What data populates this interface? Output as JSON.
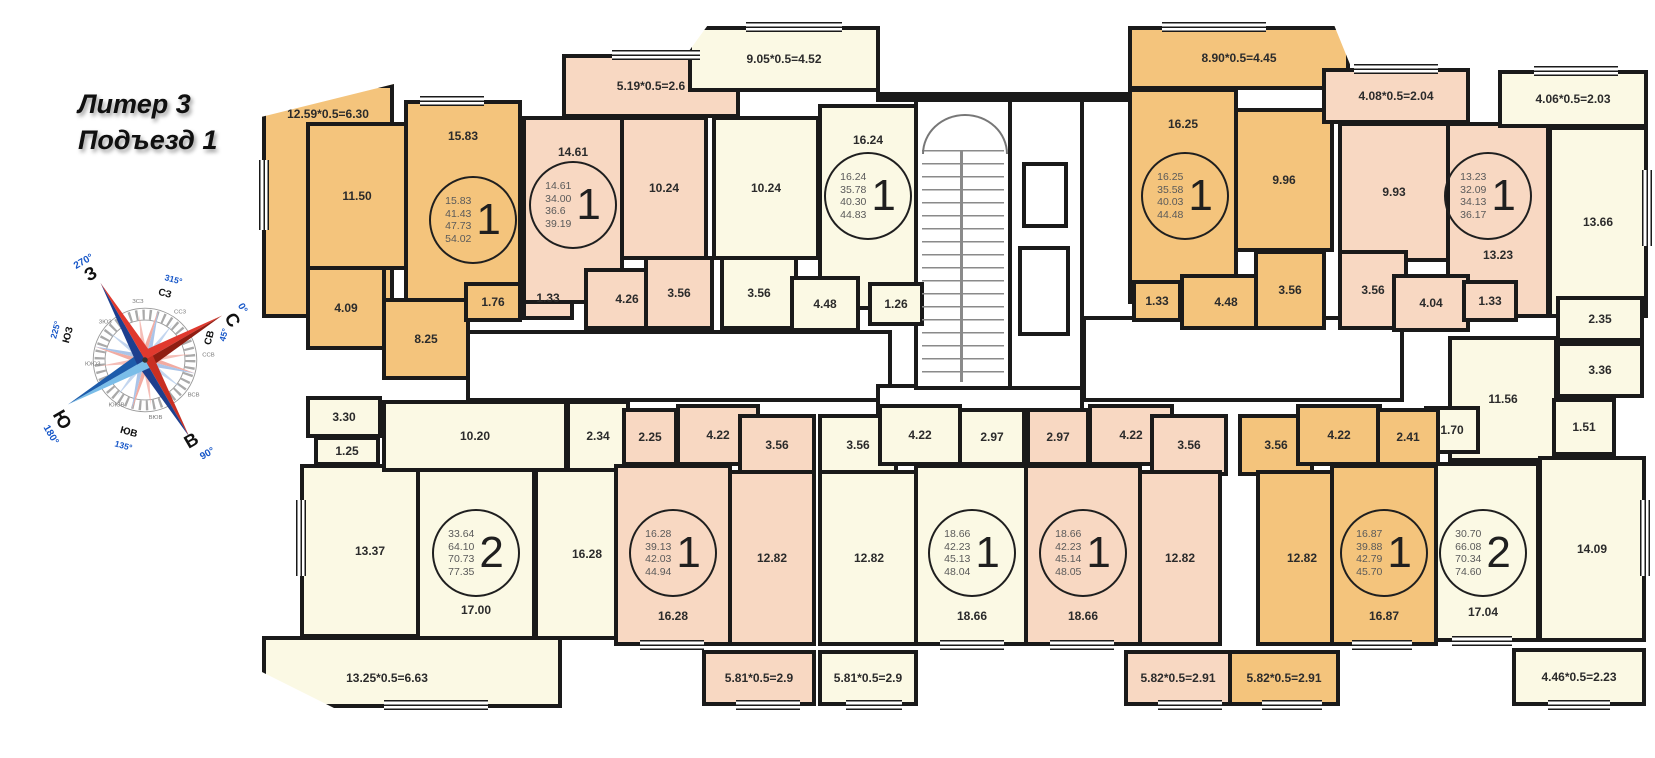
{
  "title": {
    "line1": "Литер 3",
    "line2": "Подъезд 1"
  },
  "compass": {
    "n": "С",
    "e": "В",
    "s": "Ю",
    "w": "З",
    "deg_n": "0°",
    "deg_e": "90°",
    "deg_s": "180°",
    "deg_w": "270°",
    "nw": "СЗ",
    "ne": "СВ",
    "se": "ЮВ",
    "sw": "ЮЗ",
    "deg_nw": "315°",
    "deg_ne": "45°",
    "deg_se": "135°",
    "deg_sw": "225°",
    "minor": [
      "ЗСЗ",
      "ССЗ",
      "ССВ",
      "ВСВ",
      "ВЮВ",
      "ЮЮВ",
      "ЮЮЗ",
      "ЗЮЗ"
    ]
  },
  "colors": {
    "orange": "#F4C47C",
    "pink": "#F8D8C2",
    "cream": "#FBF9E4",
    "wall": "#1a1a1a"
  },
  "rooms": [
    {
      "id": "apt1-balcony",
      "label": "12.59*0.5=6.30",
      "x": 262,
      "y": 84,
      "w": 132,
      "h": 234,
      "c": "o",
      "lp": "t",
      "clip": "polygon(0% 14%, 100% 0%, 100% 100%, 0% 100%)"
    },
    {
      "id": "apt1-kitchen",
      "label": "11.50",
      "x": 306,
      "y": 122,
      "w": 102,
      "h": 148,
      "c": "o",
      "lp": "c"
    },
    {
      "id": "apt1-room",
      "label": "15.83",
      "x": 404,
      "y": 100,
      "w": 118,
      "h": 202,
      "c": "o",
      "lp": "t"
    },
    {
      "id": "apt1-bath",
      "label": "4.09",
      "x": 306,
      "y": 266,
      "w": 80,
      "h": 84,
      "c": "o",
      "lp": "c"
    },
    {
      "id": "apt1-hall",
      "label": "8.25",
      "x": 382,
      "y": 298,
      "w": 88,
      "h": 82,
      "c": "o",
      "lp": "c"
    },
    {
      "id": "apt1-closet",
      "label": "1.76",
      "x": 464,
      "y": 282,
      "w": 58,
      "h": 40,
      "c": "o",
      "lp": "c"
    },
    {
      "id": "apt2-bath",
      "label": "3.30",
      "x": 306,
      "y": 396,
      "w": 76,
      "h": 42,
      "c": "c",
      "lp": "c"
    },
    {
      "id": "apt2-wc",
      "label": "1.25",
      "x": 314,
      "y": 436,
      "w": 66,
      "h": 30,
      "c": "c",
      "lp": "c"
    },
    {
      "id": "apt2-kitchen",
      "label": "13.37",
      "x": 300,
      "y": 464,
      "w": 140,
      "h": 174,
      "c": "c",
      "lp": "c"
    },
    {
      "id": "apt2-hall",
      "label": "10.20",
      "x": 382,
      "y": 400,
      "w": 186,
      "h": 72,
      "c": "c",
      "lp": "c"
    },
    {
      "id": "apt2-closet",
      "label": "2.34",
      "x": 566,
      "y": 400,
      "w": 64,
      "h": 72,
      "c": "c",
      "lp": "c"
    },
    {
      "id": "apt2-room1",
      "label": "17.00",
      "x": 416,
      "y": 468,
      "w": 120,
      "h": 172,
      "c": "c",
      "lp": "b"
    },
    {
      "id": "apt2-room2",
      "label": "16.28",
      "x": 534,
      "y": 468,
      "w": 106,
      "h": 172,
      "c": "c",
      "lp": "c"
    },
    {
      "id": "apt2-balcony",
      "label": "13.25*0.5=6.63",
      "x": 262,
      "y": 636,
      "w": 300,
      "h": 72,
      "c": "c",
      "lp": "c",
      "clip": "polygon(0% 0%, 100% 0%, 100% 100%, 24% 100%, 0% 50%)"
    },
    {
      "id": "apt3-closet",
      "label": "1.33",
      "x": 522,
      "y": 276,
      "w": 52,
      "h": 44,
      "c": "p",
      "lp": "c"
    },
    {
      "id": "apt3-room",
      "label": "14.61",
      "x": 522,
      "y": 116,
      "w": 102,
      "h": 188,
      "c": "p",
      "lp": "t"
    },
    {
      "id": "apt3-balcony",
      "label": "5.19*0.5=2.6",
      "x": 562,
      "y": 54,
      "w": 178,
      "h": 64,
      "c": "p",
      "lp": "c"
    },
    {
      "id": "apt3-kitchen",
      "label": "10.24",
      "x": 620,
      "y": 116,
      "w": 88,
      "h": 144,
      "c": "p",
      "lp": "c"
    },
    {
      "id": "apt3-hall",
      "label": "4.26",
      "x": 584,
      "y": 268,
      "w": 86,
      "h": 62,
      "c": "p",
      "lp": "c"
    },
    {
      "id": "apt3-bath",
      "label": "3.56",
      "x": 644,
      "y": 256,
      "w": 70,
      "h": 74,
      "c": "p",
      "lp": "c"
    },
    {
      "id": "apt4-bath",
      "label": "3.56",
      "x": 720,
      "y": 256,
      "w": 78,
      "h": 74,
      "c": "c",
      "lp": "c"
    },
    {
      "id": "apt4-kitchen",
      "label": "10.24",
      "x": 712,
      "y": 116,
      "w": 108,
      "h": 144,
      "c": "c",
      "lp": "c"
    },
    {
      "id": "apt4-balcony",
      "label": "9.05*0.5=4.52",
      "x": 688,
      "y": 26,
      "w": 192,
      "h": 66,
      "c": "c",
      "lp": "c",
      "clip": "polygon(10% 0%, 100% 0%, 100% 100%, 0% 100%, 0% 40%)"
    },
    {
      "id": "apt4-room",
      "label": "16.24",
      "x": 818,
      "y": 104,
      "w": 100,
      "h": 206,
      "c": "c",
      "lp": "t"
    },
    {
      "id": "apt4-hall",
      "label": "4.48",
      "x": 790,
      "y": 276,
      "w": 70,
      "h": 56,
      "c": "c",
      "lp": "c"
    },
    {
      "id": "apt4-closet",
      "label": "1.26",
      "x": 868,
      "y": 282,
      "w": 56,
      "h": 44,
      "c": "c",
      "lp": "c"
    },
    {
      "id": "apt10-balcony",
      "label": "8.90*0.5=4.45",
      "x": 1128,
      "y": 26,
      "w": 222,
      "h": 64,
      "c": "o",
      "lp": "c",
      "clip": "polygon(0% 0%, 93% 0%, 100% 60%, 100% 100%, 0% 100%)"
    },
    {
      "id": "apt10-room",
      "label": "16.25",
      "x": 1128,
      "y": 88,
      "w": 110,
      "h": 216,
      "c": "o",
      "lp": "t"
    },
    {
      "id": "apt10-kitchen",
      "label": "9.96",
      "x": 1234,
      "y": 108,
      "w": 100,
      "h": 144,
      "c": "o",
      "lp": "c"
    },
    {
      "id": "apt10-closet",
      "label": "1.33",
      "x": 1132,
      "y": 280,
      "w": 50,
      "h": 42,
      "c": "o",
      "lp": "c"
    },
    {
      "id": "apt10-hall",
      "label": "4.48",
      "x": 1180,
      "y": 274,
      "w": 92,
      "h": 56,
      "c": "o",
      "lp": "c"
    },
    {
      "id": "apt10-bath",
      "label": "3.56",
      "x": 1254,
      "y": 250,
      "w": 72,
      "h": 80,
      "c": "o",
      "lp": "c"
    },
    {
      "id": "apt11-balcony",
      "label": "4.08*0.5=2.04",
      "x": 1322,
      "y": 68,
      "w": 148,
      "h": 56,
      "c": "p",
      "lp": "c"
    },
    {
      "id": "apt11-kitchen",
      "label": "9.93",
      "x": 1338,
      "y": 122,
      "w": 112,
      "h": 140,
      "c": "p",
      "lp": "c"
    },
    {
      "id": "apt11-bath",
      "label": "3.56",
      "x": 1338,
      "y": 250,
      "w": 70,
      "h": 80,
      "c": "p",
      "lp": "c"
    },
    {
      "id": "apt11-room",
      "label": "13.23",
      "x": 1446,
      "y": 122,
      "w": 104,
      "h": 196,
      "c": "p",
      "lp": "ml"
    },
    {
      "id": "apt11-hall",
      "label": "4.04",
      "x": 1392,
      "y": 274,
      "w": 78,
      "h": 58,
      "c": "p",
      "lp": "c"
    },
    {
      "id": "apt11-closet",
      "label": "1.33",
      "x": 1462,
      "y": 280,
      "w": 56,
      "h": 42,
      "c": "p",
      "lp": "c"
    },
    {
      "id": "apt9-balcony-top",
      "label": "4.06*0.5=2.03",
      "x": 1498,
      "y": 70,
      "w": 150,
      "h": 58,
      "c": "c",
      "lp": "c"
    },
    {
      "id": "apt9-room1",
      "label": "13.66",
      "x": 1548,
      "y": 126,
      "w": 100,
      "h": 192,
      "c": "c",
      "lp": "c"
    },
    {
      "id": "apt9-closet235",
      "label": "2.35",
      "x": 1556,
      "y": 296,
      "w": 88,
      "h": 46,
      "c": "c",
      "lp": "c"
    },
    {
      "id": "apt9-bath",
      "label": "3.36",
      "x": 1556,
      "y": 342,
      "w": 88,
      "h": 56,
      "c": "c",
      "lp": "c"
    },
    {
      "id": "apt9-hall",
      "label": "11.56",
      "x": 1448,
      "y": 336,
      "w": 110,
      "h": 126,
      "c": "c",
      "lp": "c"
    },
    {
      "id": "apt9-closet170",
      "label": "1.70",
      "x": 1424,
      "y": 406,
      "w": 56,
      "h": 48,
      "c": "c",
      "lp": "c"
    },
    {
      "id": "apt9-wc",
      "label": "1.51",
      "x": 1552,
      "y": 398,
      "w": 64,
      "h": 58,
      "c": "c",
      "lp": "c"
    },
    {
      "id": "apt9-room2",
      "label": "17.04",
      "x": 1426,
      "y": 462,
      "w": 114,
      "h": 180,
      "c": "c",
      "lp": "b"
    },
    {
      "id": "apt9-kitchen",
      "label": "14.09",
      "x": 1538,
      "y": 456,
      "w": 108,
      "h": 186,
      "c": "c",
      "lp": "c"
    },
    {
      "id": "apt9-balcony-bottom",
      "label": "4.46*0.5=2.23",
      "x": 1512,
      "y": 648,
      "w": 134,
      "h": 58,
      "c": "c",
      "lp": "c"
    },
    {
      "id": "apt5-closet",
      "label": "2.25",
      "x": 622,
      "y": 408,
      "w": 56,
      "h": 58,
      "c": "p",
      "lp": "c"
    },
    {
      "id": "apt5-hall",
      "label": "4.22",
      "x": 676,
      "y": 404,
      "w": 84,
      "h": 62,
      "c": "p",
      "lp": "c"
    },
    {
      "id": "apt5-bath",
      "label": "3.56",
      "x": 738,
      "y": 414,
      "w": 78,
      "h": 62,
      "c": "p",
      "lp": "c"
    },
    {
      "id": "apt5-room",
      "label": "16.28",
      "x": 614,
      "y": 464,
      "w": 118,
      "h": 182,
      "c": "p",
      "lp": "b"
    },
    {
      "id": "apt5-kitchen",
      "label": "12.82",
      "x": 728,
      "y": 470,
      "w": 88,
      "h": 176,
      "c": "p",
      "lp": "c"
    },
    {
      "id": "apt5-balcony",
      "label": "5.81*0.5=2.9",
      "x": 702,
      "y": 650,
      "w": 114,
      "h": 56,
      "c": "p",
      "lp": "c"
    },
    {
      "id": "apt6-bath",
      "label": "3.56",
      "x": 818,
      "y": 414,
      "w": 80,
      "h": 62,
      "c": "c",
      "lp": "c"
    },
    {
      "id": "apt6-hall",
      "label": "4.22",
      "x": 878,
      "y": 404,
      "w": 84,
      "h": 62,
      "c": "c",
      "lp": "c"
    },
    {
      "id": "apt6-closet",
      "label": "2.97",
      "x": 958,
      "y": 408,
      "w": 68,
      "h": 58,
      "c": "c",
      "lp": "c"
    },
    {
      "id": "apt6-kitchen",
      "label": "12.82",
      "x": 818,
      "y": 470,
      "w": 102,
      "h": 176,
      "c": "c",
      "lp": "c"
    },
    {
      "id": "apt6-room",
      "label": "18.66",
      "x": 914,
      "y": 464,
      "w": 116,
      "h": 182,
      "c": "c",
      "lp": "b"
    },
    {
      "id": "apt6-balcony",
      "label": "5.81*0.5=2.9",
      "x": 818,
      "y": 650,
      "w": 100,
      "h": 56,
      "c": "c",
      "lp": "c"
    },
    {
      "id": "apt7-closet",
      "label": "2.97",
      "x": 1026,
      "y": 408,
      "w": 64,
      "h": 58,
      "c": "p",
      "lp": "c"
    },
    {
      "id": "apt7-hall",
      "label": "4.22",
      "x": 1088,
      "y": 404,
      "w": 86,
      "h": 62,
      "c": "p",
      "lp": "c"
    },
    {
      "id": "apt7-bath",
      "label": "3.56",
      "x": 1150,
      "y": 414,
      "w": 78,
      "h": 62,
      "c": "p",
      "lp": "c"
    },
    {
      "id": "apt7-room",
      "label": "18.66",
      "x": 1024,
      "y": 464,
      "w": 118,
      "h": 182,
      "c": "p",
      "lp": "b"
    },
    {
      "id": "apt7-kitchen",
      "label": "12.82",
      "x": 1138,
      "y": 470,
      "w": 84,
      "h": 176,
      "c": "p",
      "lp": "c"
    },
    {
      "id": "apt7-balcony",
      "label": "5.82*0.5=2.91",
      "x": 1124,
      "y": 650,
      "w": 108,
      "h": 56,
      "c": "p",
      "lp": "c"
    },
    {
      "id": "apt8-bath",
      "label": "3.56",
      "x": 1238,
      "y": 414,
      "w": 76,
      "h": 62,
      "c": "o",
      "lp": "c"
    },
    {
      "id": "apt8-hall",
      "label": "4.22",
      "x": 1296,
      "y": 404,
      "w": 86,
      "h": 62,
      "c": "o",
      "lp": "c"
    },
    {
      "id": "apt8-closet",
      "label": "2.41",
      "x": 1376,
      "y": 408,
      "w": 64,
      "h": 58,
      "c": "o",
      "lp": "c"
    },
    {
      "id": "apt8-kitchen",
      "label": "12.82",
      "x": 1256,
      "y": 470,
      "w": 92,
      "h": 176,
      "c": "o",
      "lp": "c"
    },
    {
      "id": "apt8-room",
      "label": "16.87",
      "x": 1330,
      "y": 464,
      "w": 108,
      "h": 182,
      "c": "o",
      "lp": "b"
    },
    {
      "id": "apt8-balcony",
      "label": "5.82*0.5=2.91",
      "x": 1228,
      "y": 650,
      "w": 112,
      "h": 56,
      "c": "o",
      "lp": "c"
    }
  ],
  "circles": [
    {
      "id": "apt1",
      "x": 473,
      "y": 220,
      "number": "1",
      "areas": [
        "15.83",
        "41.43",
        "47.73",
        "54.02"
      ]
    },
    {
      "id": "apt3",
      "x": 573,
      "y": 205,
      "number": "1",
      "areas": [
        "14.61",
        "34.00",
        "36.6",
        "39.19"
      ]
    },
    {
      "id": "apt4",
      "x": 868,
      "y": 196,
      "number": "1",
      "areas": [
        "16.24",
        "35.78",
        "40.30",
        "44.83"
      ]
    },
    {
      "id": "apt10",
      "x": 1185,
      "y": 196,
      "number": "1",
      "areas": [
        "16.25",
        "35.58",
        "40.03",
        "44.48"
      ]
    },
    {
      "id": "apt11",
      "x": 1488,
      "y": 196,
      "number": "1",
      "areas": [
        "13.23",
        "32.09",
        "34.13",
        "36.17"
      ]
    },
    {
      "id": "apt2",
      "x": 476,
      "y": 553,
      "number": "2",
      "areas": [
        "33.64",
        "64.10",
        "70.73",
        "77.35"
      ]
    },
    {
      "id": "apt5",
      "x": 673,
      "y": 553,
      "number": "1",
      "areas": [
        "16.28",
        "39.13",
        "42.03",
        "44.94"
      ]
    },
    {
      "id": "apt6",
      "x": 972,
      "y": 553,
      "number": "1",
      "areas": [
        "18.66",
        "42.23",
        "45.13",
        "48.04"
      ]
    },
    {
      "id": "apt7",
      "x": 1083,
      "y": 553,
      "number": "1",
      "areas": [
        "18.66",
        "42.23",
        "45.14",
        "48.05"
      ]
    },
    {
      "id": "apt8",
      "x": 1384,
      "y": 553,
      "number": "1",
      "areas": [
        "16.87",
        "39.88",
        "42.79",
        "45.70"
      ]
    },
    {
      "id": "apt9",
      "x": 1483,
      "y": 553,
      "number": "2",
      "areas": [
        "30.70",
        "66.08",
        "70.34",
        "74.60"
      ]
    }
  ]
}
